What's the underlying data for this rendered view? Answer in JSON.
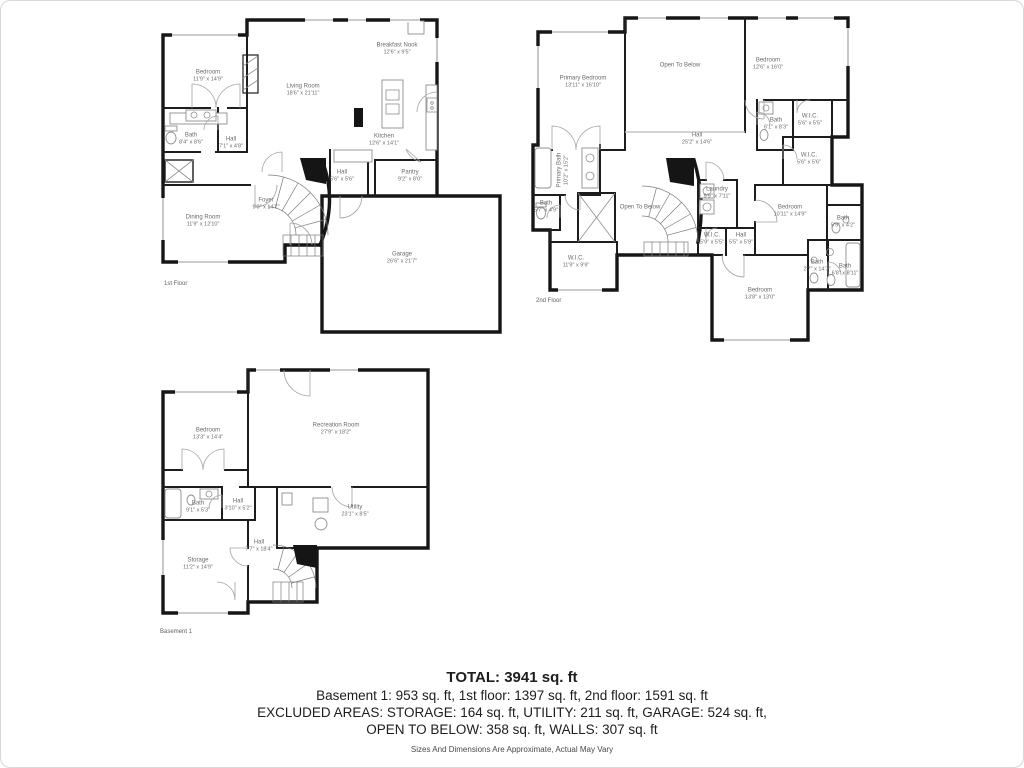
{
  "floors": [
    {
      "caption": "1st Floor",
      "rooms": [
        {
          "name": "Bedroom",
          "dims": "11'9\" x 14'9\""
        },
        {
          "name": "Bath",
          "dims": "8'4\" x 8'6\""
        },
        {
          "name": "Hall",
          "dims": "7'1\" x 4'8\""
        },
        {
          "name": "Living Room",
          "dims": "18'6\" x 21'11\""
        },
        {
          "name": "Breakfast Nook",
          "dims": "12'6\" x 9'5\""
        },
        {
          "name": "Kitchen",
          "dims": "12'6\" x 14'1\""
        },
        {
          "name": "Hall",
          "dims": "5'6\" x 5'6\""
        },
        {
          "name": "Pantry",
          "dims": "9'2\" x 8'0\""
        },
        {
          "name": "Foyer",
          "dims": "9'0\" x 14'7\""
        },
        {
          "name": "Dining Room",
          "dims": "11'9\" x 12'10\""
        },
        {
          "name": "Garage",
          "dims": "26'6\" x 21'7\""
        }
      ]
    },
    {
      "caption": "2nd Floor",
      "rooms": [
        {
          "name": "Primary Bedroom",
          "dims": "13'11\" x 16'10\""
        },
        {
          "name": "Open To Below",
          "dims": ""
        },
        {
          "name": "Bedroom",
          "dims": "12'6\" x 16'0\""
        },
        {
          "name": "Hall",
          "dims": "25'2\" x 14'6\""
        },
        {
          "name": "Bath",
          "dims": "6'1\" x 8'3\""
        },
        {
          "name": "W.I.C.",
          "dims": "5'6\" x 5'5\""
        },
        {
          "name": "W.I.C.",
          "dims": "5'6\" x 5'6\""
        },
        {
          "name": "Primary Bath",
          "dims": "10'2\" x 15'2\""
        },
        {
          "name": "Bath",
          "dims": "5'7\" x 4'9\""
        },
        {
          "name": "Open To Below",
          "dims": ""
        },
        {
          "name": "Laundry",
          "dims": "9'9\" x 7'11\""
        },
        {
          "name": "W.I.C.",
          "dims": "11'9\" x 9'9\""
        },
        {
          "name": "W.I.C.",
          "dims": "5'9\" x 5'5\""
        },
        {
          "name": "Hall",
          "dims": "5'5\" x 5'9\""
        },
        {
          "name": "Bedroom",
          "dims": "10'11\" x 14'9\""
        },
        {
          "name": "Bath",
          "dims": "5'9\" x 4'2\""
        },
        {
          "name": "Bath",
          "dims": "2'7\" x 14'7\""
        },
        {
          "name": "Bath",
          "dims": "6'8\" x 8'11\""
        },
        {
          "name": "Bedroom",
          "dims": "13'8\" x 13'0\""
        }
      ]
    },
    {
      "caption": "Basement 1",
      "rooms": [
        {
          "name": "Bedroom",
          "dims": "13'3\" x 14'4\""
        },
        {
          "name": "Recreation Room",
          "dims": "27'9\" x 18'2\""
        },
        {
          "name": "Bath",
          "dims": "9'1\" x 5'3\""
        },
        {
          "name": "Hall",
          "dims": "3'10\" x 5'2\""
        },
        {
          "name": "Utility",
          "dims": "23'1\" x 8'5\""
        },
        {
          "name": "Hall",
          "dims": "7'7\" x 18'4\""
        },
        {
          "name": "Storage",
          "dims": "11'2\" x 14'9\""
        }
      ]
    }
  ],
  "summary": {
    "total": "TOTAL: 3941 sq. ft",
    "floors_line": "Basement 1: 953 sq. ft, 1st floor: 1397 sq. ft, 2nd floor: 1591 sq. ft",
    "excluded_line1": "EXCLUDED AREAS: STORAGE: 164 sq. ft, UTILITY: 211 sq. ft, GARAGE: 524 sq. ft,",
    "excluded_line2": "OPEN TO BELOW: 358 sq. ft, WALLS: 307 sq. ft",
    "disclaimer": "Sizes And Dimensions Are Approximate, Actual May Vary"
  }
}
